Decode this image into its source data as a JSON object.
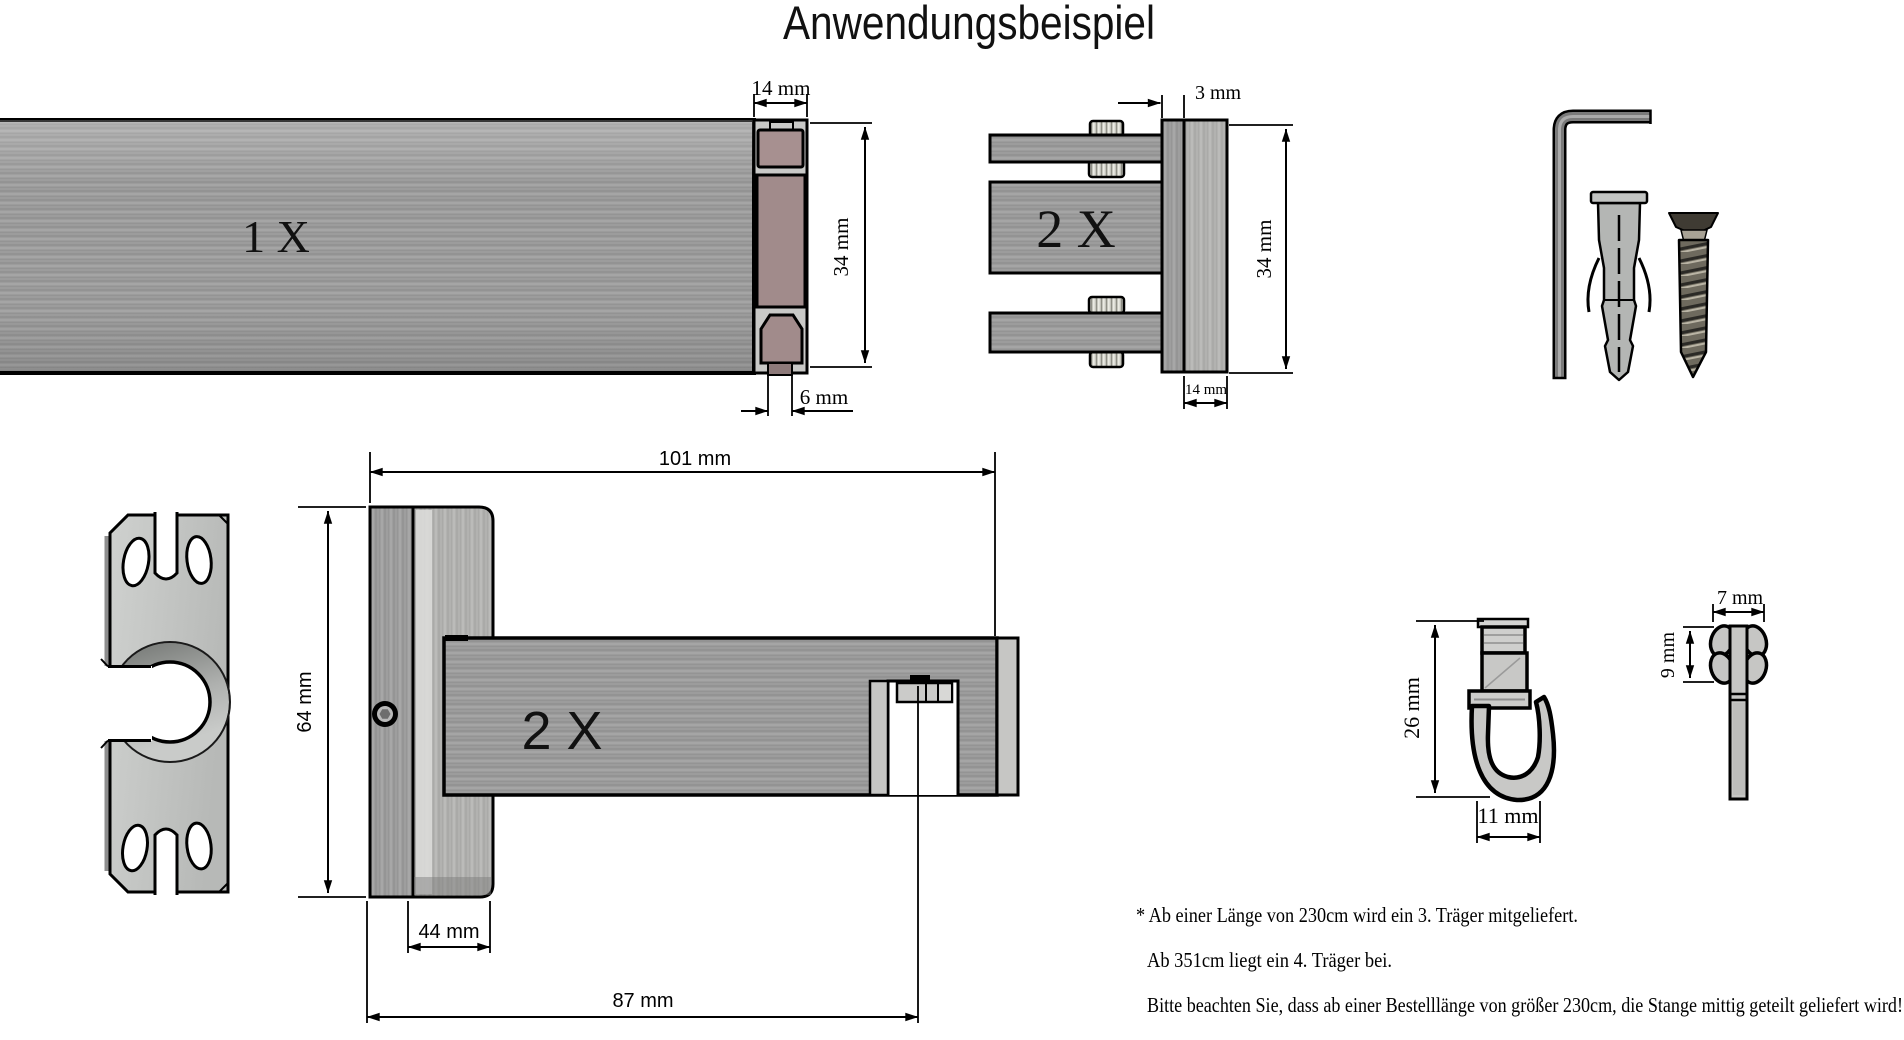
{
  "title": "Anwendungsbeispiel",
  "colors": {
    "background": "#ffffff",
    "outline": "#000000",
    "metal_gray": "#9c9c9c",
    "metal_light": "#c9c9c7",
    "cap_insert_rosy": "#a79090",
    "plate_gray": "#c6c8c6"
  },
  "figures": {
    "rail": {
      "quantity": "1 X",
      "dim_width": "14 mm",
      "dim_height": "34 mm",
      "dim_groove": "6 mm"
    },
    "bracket_end": {
      "quantity": "2 X",
      "dim_gap": "3 mm",
      "dim_height": "34 mm",
      "dim_depth": "14 mm"
    },
    "bracket_side": {
      "quantity": "2 X",
      "dim_length": "101 mm",
      "dim_height": "64 mm",
      "dim_plate": "44 mm",
      "dim_reach": "87 mm"
    },
    "glider": {
      "dim_height": "26 mm",
      "dim_width": "11 mm"
    },
    "end_stop": {
      "dim_width": "7 mm",
      "dim_height": "9 mm"
    }
  },
  "notes": [
    "* Ab einer Länge von 230cm wird ein 3. Träger mitgeliefert.",
    "Ab 351cm liegt ein 4. Träger bei.",
    "Bitte beachten Sie, dass ab einer Bestelllänge von größer 230cm, die Stange mittig geteilt geliefert wird!"
  ]
}
